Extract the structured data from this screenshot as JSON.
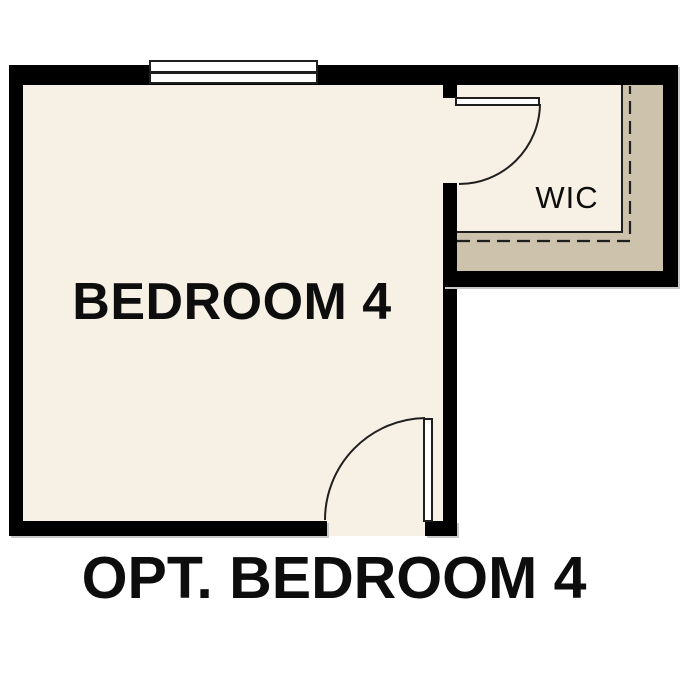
{
  "plan": {
    "caption": "OPT. BEDROOM 4",
    "rooms": [
      {
        "name": "BEDROOM 4"
      },
      {
        "name": "WIC"
      }
    ],
    "symbols": [
      "window-symbol",
      "wic-door-swing",
      "bedroom-door-swing",
      "closet-shelf-dashed-line"
    ],
    "colors": {
      "background": "#ffffff",
      "wall": "#000000",
      "line": "#1f1f1f",
      "text": "#0d0d0d",
      "room_fill": "#f7f0e4",
      "closet_band_fill": "#cdc2ab",
      "shadow": "#c9c9c9"
    }
  }
}
